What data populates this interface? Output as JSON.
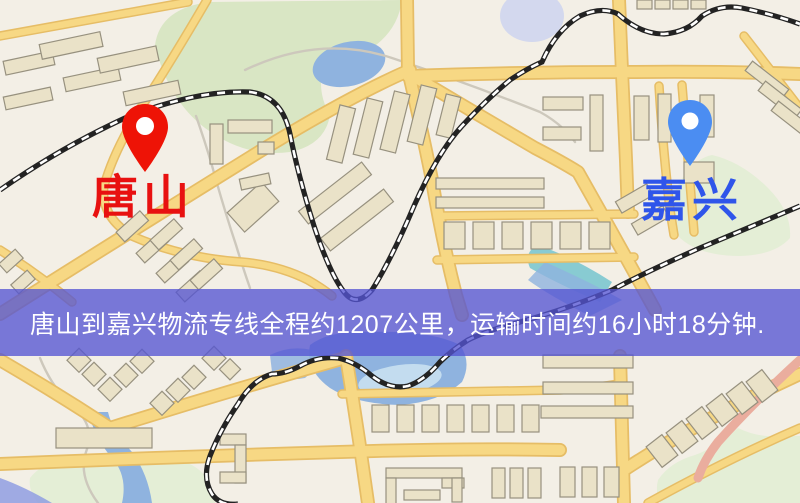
{
  "banner": {
    "text": "唐山到嘉兴物流专线全程约1207公里，运输时间约16小时18分钟."
  },
  "markers": {
    "origin": {
      "label": "唐山"
    },
    "destination": {
      "label": "嘉兴"
    }
  },
  "colors": {
    "map_bg": "#f3efe6",
    "road_fill": "#f7d884",
    "road_casing": "#e6bd66",
    "building_fill": "#eae2c8",
    "building_stroke": "#97917f",
    "park": "#d9e6c4",
    "water": "#8fb3df",
    "teal_water": "#7cc6cf",
    "railway": "#232323",
    "salmon_road": "#eaad9e",
    "banner_bg": "rgba(84,85,210,0.78)",
    "banner_text": "#ffffff",
    "origin_pin": "#ee1306",
    "origin_label": "#e81110",
    "destination_pin": "#4b8df2",
    "destination_label": "#2f55ea"
  }
}
